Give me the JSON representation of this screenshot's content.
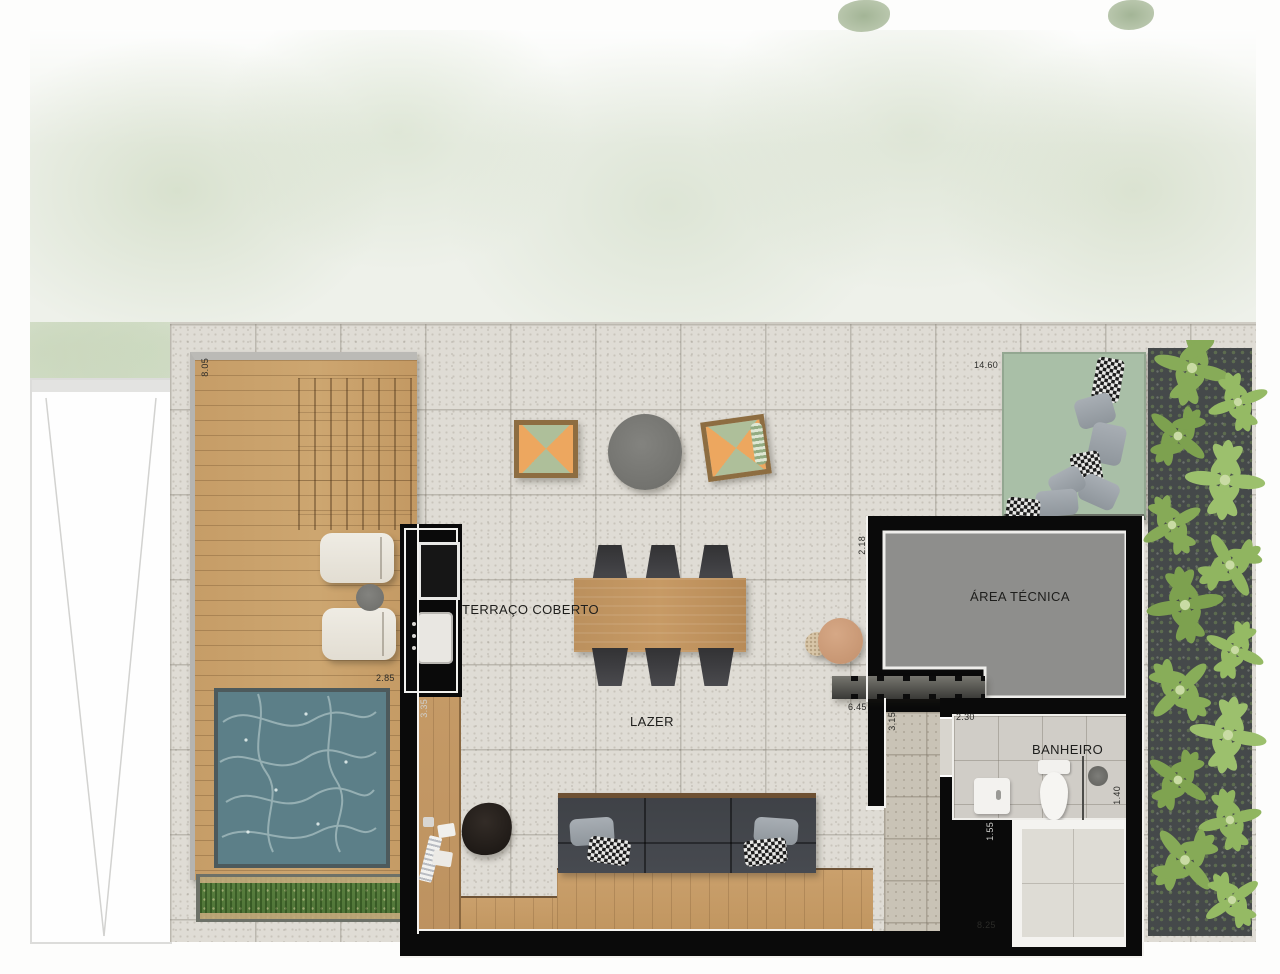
{
  "floor_plan": {
    "type": "rooftop-terrace-plan",
    "rooms": [
      {
        "id": "terraco_coberto",
        "label": "TERRAÇO COBERTO"
      },
      {
        "id": "lazer",
        "label": "LAZER"
      },
      {
        "id": "area_tecnica",
        "label": "ÁREA TÉCNICA"
      },
      {
        "id": "banheiro",
        "label": "BANHEIRO"
      }
    ],
    "dimensions": {
      "deck_depth": "8.05",
      "terrace_width": "14.60",
      "deck_width": "2.85",
      "counter_run": "3.35",
      "tecnica_wall": "2.18",
      "stair_run": "6.45",
      "hall_depth": "3.15",
      "banheiro_width": "2.30",
      "banheiro_depth": "1.40",
      "shaft_width": "1.55",
      "lazer_width": "8.25"
    },
    "colors": {
      "wall_black": "#0a0a0a",
      "terrace_tile": "#dfdcd5",
      "deck_wood": "#c69d67",
      "pool_water": "#5c7f88",
      "daybed_green": "#a9bfa7",
      "tecnica_floor": "#8e8e8c",
      "foliage_green": "#8fb362",
      "grass_green": "#57823b",
      "cushion_orange": "#eda75f",
      "cushion_green": "#aebf9a"
    }
  }
}
